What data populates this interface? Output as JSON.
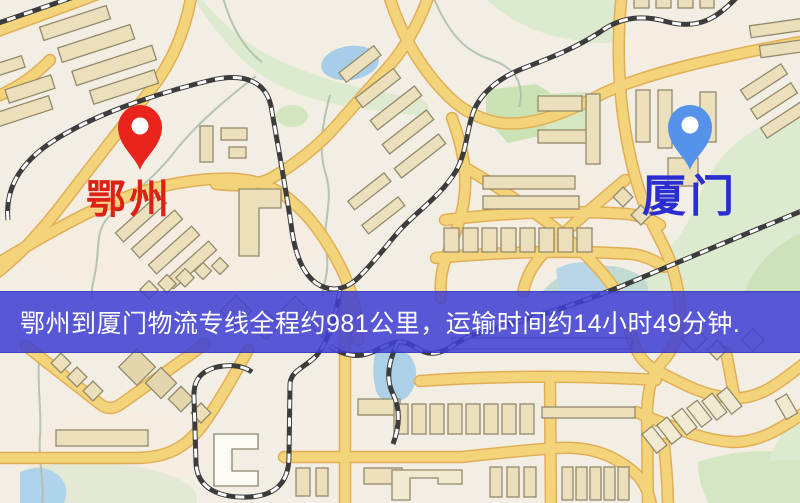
{
  "map": {
    "origin": {
      "label": "鄂州",
      "pin": "red-location-pin"
    },
    "destination": {
      "label": "厦门",
      "pin": "blue-location-pin"
    },
    "banner": {
      "text": "鄂州到厦门物流专线全程约981公里，运输时间约14小时49分钟."
    },
    "route_facts": {
      "origin_city": "鄂州",
      "destination_city": "厦门",
      "distance": "约981公里",
      "duration": "约14小时49分钟"
    },
    "colors": {
      "origin_label": "#de2115",
      "origin_pin": "#e8241c",
      "destination_label": "#2a2ed2",
      "destination_pin": "#5593ea",
      "banner_background": "#4040d2",
      "banner_text": "#ffffff",
      "road_fill": "#f4d47a",
      "road_casing": "#e2ae55",
      "water": "#a8cde9",
      "park": "#d6e8c2",
      "building": "#ebdfbc",
      "railway": "#3c3c3c"
    }
  }
}
